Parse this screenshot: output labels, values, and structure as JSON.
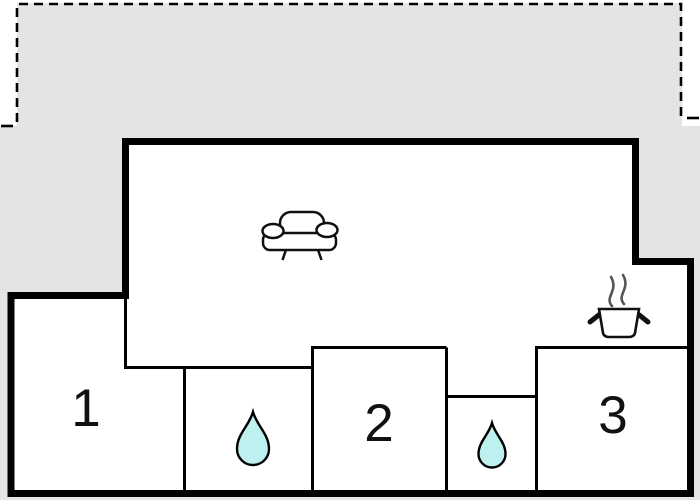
{
  "floor_plan": {
    "type": "apartment-floor-plan",
    "colors": {
      "terrace_fill": "#e4e4e6",
      "wall": "#000000",
      "room_fill": "#ffffff",
      "water_drop_fill": "#bdf0ee",
      "steam": "#555555"
    },
    "terrace": {
      "boundary_style": "dashed",
      "label": ""
    },
    "rooms": [
      {
        "id": "room-1",
        "label": "1"
      },
      {
        "id": "room-2",
        "label": "2"
      },
      {
        "id": "room-3",
        "label": "3"
      }
    ],
    "icons": [
      {
        "name": "sofa-icon",
        "meaning": "living room seating"
      },
      {
        "name": "cooking-pot-icon",
        "meaning": "kitchen / stove"
      },
      {
        "name": "water-drop-icon",
        "meaning": "bathroom 1"
      },
      {
        "name": "water-drop-icon",
        "meaning": "bathroom 2"
      }
    ]
  }
}
